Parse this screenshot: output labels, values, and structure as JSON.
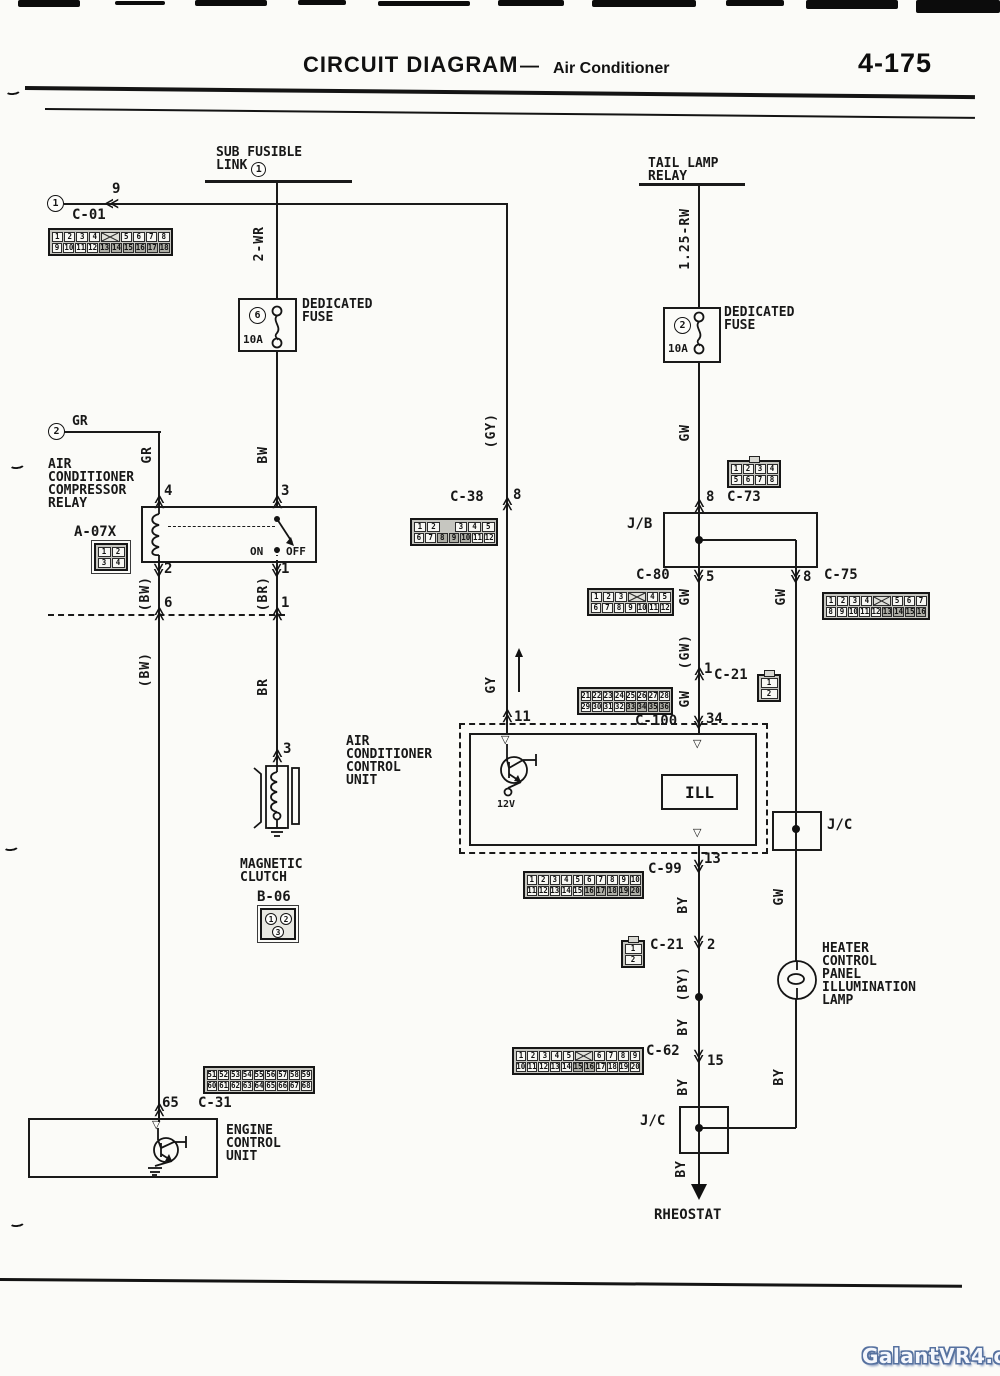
{
  "header": {
    "title": "CIRCUIT DIAGRAM",
    "dash": "—",
    "subtitle": "Air Conditioner",
    "page_no": "4-175"
  },
  "watermark": {
    "text": "GalantVR4.org"
  },
  "labels": {
    "sub_fusible_1": "SUB FUSIBLE",
    "sub_fusible_2": "LINK",
    "sub_fusible_circle": "1",
    "tail_relay_1": "TAIL LAMP",
    "tail_relay_2": "RELAY",
    "source1_circle": "1",
    "source1_pin": "9",
    "c01": "C-01",
    "source2_circle": "2",
    "source2_wire": "GR",
    "fuse_left_no": "6",
    "fuse_left_rating": "10A",
    "fuse_left_1": "DEDICATED",
    "fuse_left_2": "FUSE",
    "fuse_right_no": "2",
    "fuse_right_rating": "10A",
    "fuse_right_1": "DEDICATED",
    "fuse_right_2": "FUSE",
    "relay_1": "AIR",
    "relay_2": "CONDITIONER",
    "relay_3": "COMPRESSOR",
    "relay_4": "RELAY",
    "relay_pin4": "4",
    "relay_pin3": "3",
    "relay_pin2": "2",
    "relay_pin1": "1",
    "relay_on": "ON",
    "relay_off": "OFF",
    "a07x": "A-07X",
    "inline_pin6": "6",
    "inline_pin1": "1",
    "clutch_pin": "3",
    "clutch_1": "MAGNETIC",
    "clutch_2": "CLUTCH",
    "b06": "B-06",
    "c38": "C-38",
    "c38_pin": "8",
    "c73": "C-73",
    "c73_pin": "8",
    "jb": "J/B",
    "jb_pin5": "5",
    "jb_pin8": "8",
    "c80": "C-80",
    "c75": "C-75",
    "c21a": "C-21",
    "c21a_pin": "1",
    "c100": "C-100",
    "c100_pin": "34",
    "cu_pin11": "11",
    "cu_1": "AIR",
    "cu_2": "CONDITIONER",
    "cu_3": "CONTROL",
    "cu_4": "UNIT",
    "cu_12v": "12V",
    "cu_ill": "ILL",
    "cu_pin13": "13",
    "c99": "C-99",
    "c21b": "C-21",
    "c21b_pin": "2",
    "c62": "C-62",
    "c62_pin": "15",
    "jc_right": "J/C",
    "jc_bottom": "J/C",
    "lamp_1": "HEATER",
    "lamp_2": "CONTROL",
    "lamp_3": "PANEL",
    "lamp_4": "ILLUMINATION",
    "lamp_5": "LAMP",
    "ecu_pin": "65",
    "c31": "C-31",
    "ecu_1": "ENGINE",
    "ecu_2": "CONTROL",
    "ecu_3": "UNIT",
    "rheostat": "RHEOSTAT"
  },
  "wire_labels": {
    "sub_fuse_in": "2-WR",
    "tail_relay_in": "1.25-RW",
    "gr_vertical": "GR",
    "bw_fuse_out": "BW",
    "gy_paren": "(GY)",
    "gy_control_in": "GY",
    "gw_fuse_out": "GW",
    "gw_jb_left": "GW",
    "gw_jb_right": "GW",
    "gw_paren": "(GW)",
    "gw_c21_below": "GW",
    "gw_lamp_in": "GW",
    "bw_paren_upper": "(BW)",
    "bw_paren_lower": "(BW)",
    "br_paren": "(BR)",
    "br_clutch_in": "BR",
    "by_c99_out": "BY",
    "by_paren": "(BY)",
    "by_c62_in": "BY",
    "by_c62_out": "BY",
    "by_lamp_out": "BY",
    "by_rheostat": "BY"
  },
  "connectors": {
    "c01": {
      "rows": [
        [
          "1",
          "2",
          "3",
          "4",
          "X",
          "5",
          "6",
          "7",
          "8"
        ],
        [
          "9",
          "10",
          "11",
          "12",
          "13",
          "14",
          "15",
          "16",
          "17",
          "18"
        ]
      ],
      "shaded": [
        "13",
        "14",
        "15",
        "16",
        "17",
        "18"
      ]
    },
    "c38": {
      "rows": [
        [
          "1",
          "2",
          "_",
          "3",
          "4",
          "5"
        ],
        [
          "6",
          "7",
          "8",
          "9",
          "10",
          "11",
          "12"
        ]
      ],
      "shaded": [
        "8",
        "9",
        "10"
      ]
    },
    "c73": {
      "rows": [
        [
          "1",
          "2",
          "3",
          "4"
        ],
        [
          "5",
          "6",
          "7",
          "8"
        ]
      ],
      "shaded": []
    },
    "c80": {
      "rows": [
        [
          "1",
          "2",
          "3",
          "X",
          "4",
          "5"
        ],
        [
          "6",
          "7",
          "8",
          "9",
          "10",
          "11",
          "12"
        ]
      ],
      "shaded": []
    },
    "c75": {
      "rows": [
        [
          "1",
          "2",
          "3",
          "4",
          "X",
          "5",
          "6",
          "7"
        ],
        [
          "8",
          "9",
          "10",
          "11",
          "12",
          "13",
          "14",
          "15",
          "16"
        ]
      ],
      "shaded": [
        "13",
        "14",
        "15",
        "16"
      ]
    },
    "c21a": {
      "rows": [
        [
          "1"
        ],
        [
          "2"
        ]
      ],
      "shaded": []
    },
    "c100": {
      "rows": [
        [
          "21",
          "22",
          "23",
          "24",
          "25",
          "26",
          "27",
          "28"
        ],
        [
          "29",
          "30",
          "31",
          "32",
          "33",
          "34",
          "35",
          "36"
        ]
      ],
      "shaded": [
        "33",
        "34",
        "35",
        "36"
      ]
    },
    "c99": {
      "rows": [
        [
          "1",
          "2",
          "3",
          "4",
          "5",
          "6",
          "7",
          "8",
          "9",
          "10"
        ],
        [
          "11",
          "12",
          "13",
          "14",
          "15",
          "16",
          "17",
          "18",
          "19",
          "20"
        ]
      ],
      "shaded": [
        "16",
        "17",
        "18",
        "19",
        "20"
      ]
    },
    "c21b": {
      "rows": [
        [
          "1"
        ],
        [
          "2"
        ]
      ],
      "shaded": []
    },
    "c62": {
      "rows": [
        [
          "1",
          "2",
          "3",
          "4",
          "5",
          "X",
          "6",
          "7",
          "8",
          "9"
        ],
        [
          "10",
          "11",
          "12",
          "13",
          "14",
          "15",
          "16",
          "17",
          "18",
          "19",
          "20"
        ]
      ],
      "shaded": [
        "15",
        "16"
      ]
    },
    "c31": {
      "rows": [
        [
          "51",
          "52",
          "53",
          "54",
          "55",
          "56",
          "57",
          "58",
          "59"
        ],
        [
          "60",
          "61",
          "62",
          "63",
          "64",
          "65",
          "66",
          "67",
          "68"
        ]
      ],
      "shaded": []
    },
    "a07x": {
      "rows": [
        [
          "1",
          "2"
        ],
        [
          "3",
          "4"
        ]
      ],
      "shaded": []
    },
    "b06": {
      "pins": [
        "1",
        "2",
        "3"
      ]
    }
  }
}
